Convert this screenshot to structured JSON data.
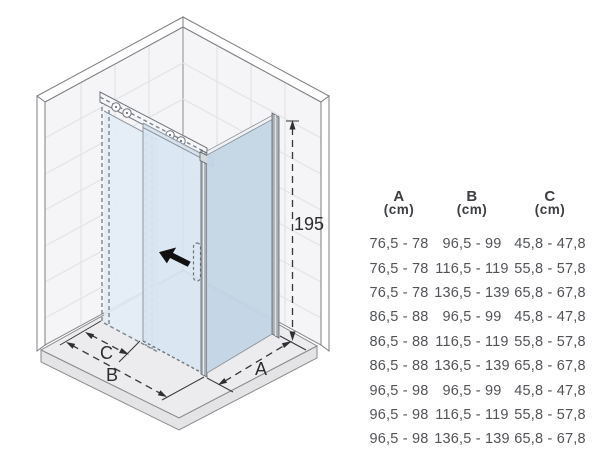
{
  "drawing": {
    "height_label": "195",
    "dim_a": "A",
    "dim_b": "B",
    "dim_c": "C",
    "slide_direction_icon": "arrow-up-left",
    "colors": {
      "wall": "#f5f5f7",
      "floor": "#ececee",
      "floor_edge": "#e4e4e7",
      "fixed_glass": "#e3edf6",
      "door_glass": "#d8e5f1",
      "side_glass": "#c3d6e5",
      "metal": "#aab0b7",
      "direction_arrow": "#111111",
      "line": "#35353a"
    }
  },
  "table": {
    "headers": [
      {
        "letter": "A",
        "unit": "(cm)"
      },
      {
        "letter": "B",
        "unit": "(cm)"
      },
      {
        "letter": "C",
        "unit": "(cm)"
      }
    ],
    "rows": [
      [
        "76,5 - 78",
        "96,5 - 99",
        "45,8 - 47,8"
      ],
      [
        "76,5 - 78",
        "116,5 - 119",
        "55,8 - 57,8"
      ],
      [
        "76,5 - 78",
        "136,5 - 139",
        "65,8 - 67,8"
      ],
      [
        "86,5 - 88",
        "96,5 - 99",
        "45,8 - 47,8"
      ],
      [
        "86,5 - 88",
        "116,5 - 119",
        "55,8 - 57,8"
      ],
      [
        "86,5 - 88",
        "136,5 - 139",
        "65,8 - 67,8"
      ],
      [
        "96,5 - 98",
        "96,5 - 99",
        "45,8 - 47,8"
      ],
      [
        "96,5 - 98",
        "116,5 - 119",
        "55,8 - 57,8"
      ],
      [
        "96,5 - 98",
        "136,5 - 139",
        "65,8 - 67,8"
      ]
    ]
  }
}
